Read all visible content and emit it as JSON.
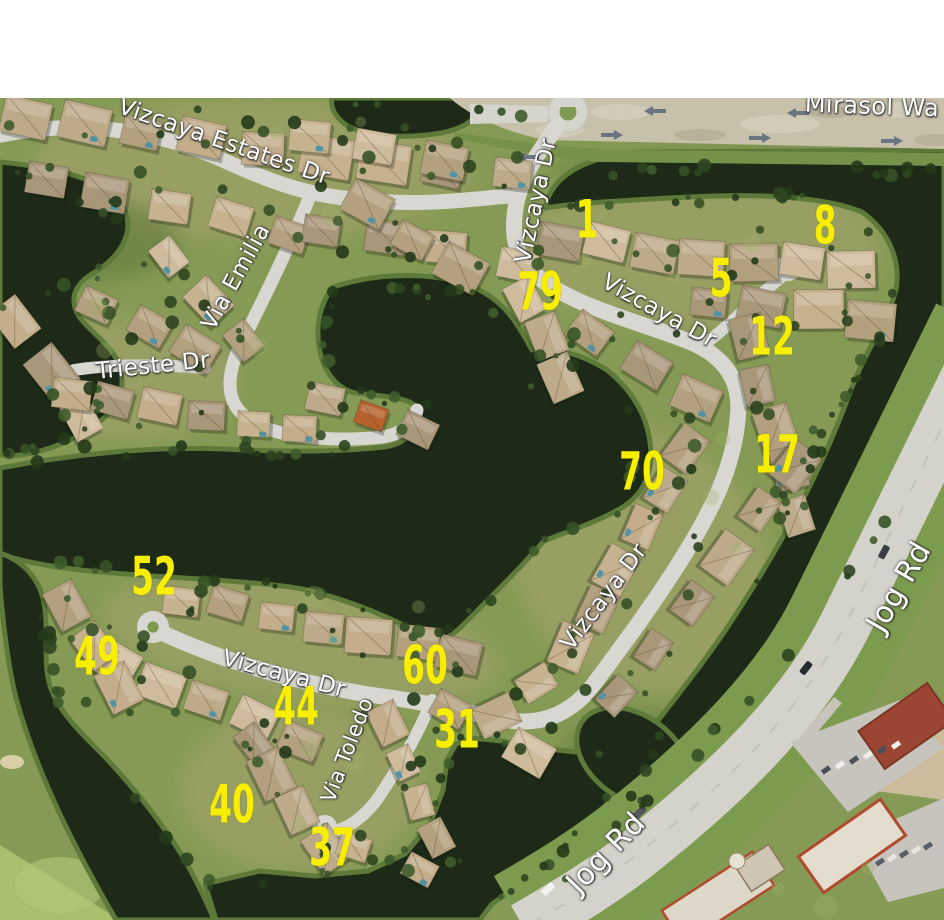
{
  "window": {
    "width": 944,
    "height": 920,
    "top_margin_height": 98,
    "background": "#ffffff"
  },
  "map": {
    "description": "Aerial photograph of the Vizcaya residential community with labeled streets, lakes, golf course and yellow lot numbers",
    "colors": {
      "water": "#1d2a17",
      "shore_bank": "#5d7a3b",
      "grass": "#859b55",
      "golf_grass": "#a9bf6e",
      "road": "#d8d7d1",
      "major_road": "#d4d3cb",
      "roof_tan": "#c6b28f",
      "street_label_text": "#ffffff",
      "lot_number_text": "#f8ee00"
    },
    "street_labels": [
      {
        "id": "vizcaya-estates-dr",
        "text": "Vizcaya Estates Dr",
        "x": 224,
        "y": 142,
        "rotation": 19,
        "font_size": 23
      },
      {
        "id": "mirasol-way",
        "text": "Mirasol Wa",
        "x": 872,
        "y": 106,
        "rotation": 2,
        "font_size": 24,
        "clipped_right": true
      },
      {
        "id": "vizcaya-dr-north",
        "text": "Vizcaya Dr",
        "x": 536,
        "y": 201,
        "rotation": -78,
        "font_size": 23
      },
      {
        "id": "vizcaya-dr-northeast",
        "text": "Vizcaya Dr",
        "x": 659,
        "y": 311,
        "rotation": 29,
        "font_size": 23
      },
      {
        "id": "via-emilia",
        "text": "Via Emilia",
        "x": 236,
        "y": 277,
        "rotation": -61,
        "font_size": 23
      },
      {
        "id": "trieste-dr",
        "text": "Trieste Dr",
        "x": 153,
        "y": 366,
        "rotation": -6,
        "font_size": 23
      },
      {
        "id": "vizcaya-dr-east",
        "text": "Vizcaya Dr",
        "x": 604,
        "y": 597,
        "rotation": -53,
        "font_size": 23
      },
      {
        "id": "vizcaya-dr-south",
        "text": "Vizcaya Dr",
        "x": 284,
        "y": 674,
        "rotation": 15,
        "font_size": 23
      },
      {
        "id": "via-toledo",
        "text": "Via Toledo",
        "x": 347,
        "y": 750,
        "rotation": -69,
        "font_size": 21
      },
      {
        "id": "jog-rd-east",
        "text": "Jog Rd",
        "x": 899,
        "y": 587,
        "rotation": -60,
        "font_size": 30
      },
      {
        "id": "jog-rd-south",
        "text": "Jog Rd",
        "x": 606,
        "y": 853,
        "rotation": -46,
        "font_size": 30
      }
    ],
    "lot_numbers": [
      {
        "value": "1",
        "x": 587,
        "y": 220
      },
      {
        "value": "8",
        "x": 825,
        "y": 226
      },
      {
        "value": "5",
        "x": 721,
        "y": 279
      },
      {
        "value": "79",
        "x": 540,
        "y": 292
      },
      {
        "value": "12",
        "x": 772,
        "y": 337
      },
      {
        "value": "17",
        "x": 777,
        "y": 455
      },
      {
        "value": "70",
        "x": 642,
        "y": 472
      },
      {
        "value": "52",
        "x": 154,
        "y": 577
      },
      {
        "value": "49",
        "x": 97,
        "y": 657
      },
      {
        "value": "60",
        "x": 425,
        "y": 666
      },
      {
        "value": "44",
        "x": 296,
        "y": 707
      },
      {
        "value": "31",
        "x": 457,
        "y": 730
      },
      {
        "value": "40",
        "x": 232,
        "y": 805
      },
      {
        "value": "37",
        "x": 332,
        "y": 848
      }
    ]
  }
}
